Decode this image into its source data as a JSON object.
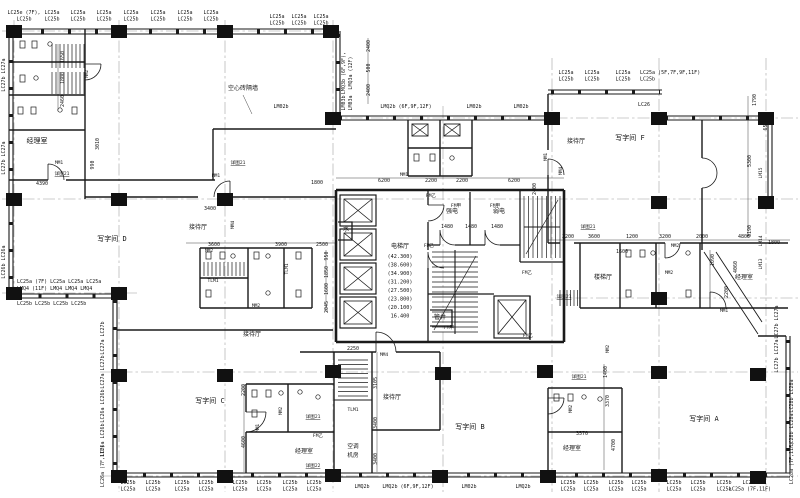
{
  "drawing": {
    "type": "architectural floor plan (office tower typical floor)",
    "ink": "#1a1a1a",
    "axis_color": "#9a9a9a"
  },
  "window_tags": [
    {
      "t": "LC25e (7F),",
      "t2": "LC25b",
      "x": 24,
      "y": 14
    },
    {
      "t": "LC25a",
      "t2": "LC25b",
      "x": 52,
      "y": 14
    },
    {
      "t": "LC25a",
      "t2": "LC25b",
      "x": 78,
      "y": 14
    },
    {
      "t": "LC25a",
      "t2": "LC25b",
      "x": 104,
      "y": 14
    },
    {
      "t": "LC25a",
      "t2": "LC25b",
      "x": 131,
      "y": 14
    },
    {
      "t": "LC25a",
      "t2": "LC25b",
      "x": 158,
      "y": 14
    },
    {
      "t": "LC25a",
      "t2": "LC25b",
      "x": 185,
      "y": 14
    },
    {
      "t": "LC25a",
      "t2": "LC25b",
      "x": 211,
      "y": 14
    },
    {
      "t": "LC25a",
      "t2": "LC25b",
      "x": 277,
      "y": 18
    },
    {
      "t": "LC25a",
      "t2": "LC25b",
      "x": 299,
      "y": 18
    },
    {
      "t": "LC25a",
      "t2": "LC25b",
      "x": 321,
      "y": 18
    },
    {
      "t": "LC25a",
      "t2": "LC25b",
      "x": 566,
      "y": 74
    },
    {
      "t": "LC25a",
      "t2": "LC25b",
      "x": 592,
      "y": 74
    },
    {
      "t": "LC25a",
      "t2": "LC25b",
      "x": 623,
      "y": 74
    },
    {
      "t": "LC25a (5F,7F,9F,11F)",
      "t2": "LC25b",
      "x": 640,
      "y": 74,
      "a": "start"
    },
    {
      "t": "LC26",
      "x": 644,
      "y": 106
    },
    {
      "t": "LMQ3b (6F,9F),",
      "x": 345,
      "y": 73,
      "r": -90
    },
    {
      "t": "LMQ3a (12F)",
      "x": 352,
      "y": 73,
      "r": -90
    },
    {
      "t": "LM03b",
      "x": 345,
      "y": 103,
      "r": -90
    },
    {
      "t": "LM03a",
      "x": 352,
      "y": 103,
      "r": -90
    },
    {
      "t": "LM02b",
      "x": 281,
      "y": 108
    },
    {
      "t": "LMQ2b (6F,9F,12F)",
      "x": 406,
      "y": 108
    },
    {
      "t": "LM02b",
      "x": 474,
      "y": 108
    },
    {
      "t": "LM02b",
      "x": 521,
      "y": 108
    },
    {
      "t": "LC27b LC27a",
      "x": 5,
      "y": 75,
      "r": -90
    },
    {
      "t": "LC27b LC27a",
      "x": 5,
      "y": 158,
      "r": -90
    },
    {
      "t": "LC26b LC26a",
      "x": 5,
      "y": 262,
      "r": -90
    },
    {
      "t": "LC25a (7F)   LC25a    LC25a    LC25a",
      "x": 17,
      "y": 283,
      "a": "start"
    },
    {
      "t": "LMQ4 (11F)  LMQ4    LMQ4    LMQ4",
      "x": 17,
      "y": 290,
      "a": "start"
    },
    {
      "t": "LC25b       LC25b     LC25b     LC25b",
      "x": 17,
      "y": 305,
      "a": "start"
    },
    {
      "t": "LC27a LC27b",
      "x": 104,
      "y": 338,
      "r": -90
    },
    {
      "t": "LC27a LC27b",
      "x": 104,
      "y": 372,
      "r": -90
    },
    {
      "t": "LC26a LC26b",
      "x": 104,
      "y": 406,
      "r": -90
    },
    {
      "t": "LC26a LC26b",
      "x": 104,
      "y": 440,
      "r": -90
    },
    {
      "t": "LC26a (7F,11F)",
      "x": 104,
      "y": 466,
      "r": -90
    },
    {
      "t": "LC27b LC27a",
      "x": 778,
      "y": 322,
      "r": -90
    },
    {
      "t": "LC27b LC27a",
      "x": 778,
      "y": 356,
      "r": -90
    },
    {
      "t": "LC28b LC28a",
      "x": 793,
      "y": 396,
      "r": -90
    },
    {
      "t": "LC28b LC28a",
      "x": 793,
      "y": 430,
      "r": -90
    },
    {
      "t": "LC28a (7F,11F)",
      "x": 793,
      "y": 463,
      "r": -90
    },
    {
      "t": "LC25b",
      "t2": "LC25a",
      "x": 128,
      "y": 484
    },
    {
      "t": "LC25b",
      "t2": "LC25a",
      "x": 153,
      "y": 484
    },
    {
      "t": "LC25b",
      "t2": "LC25a",
      "x": 182,
      "y": 484
    },
    {
      "t": "LC25b",
      "t2": "LC25a",
      "x": 206,
      "y": 484
    },
    {
      "t": "LC25b",
      "t2": "LC25a",
      "x": 240,
      "y": 484
    },
    {
      "t": "LC25b",
      "t2": "LC25a",
      "x": 264,
      "y": 484
    },
    {
      "t": "LC25b",
      "t2": "LC25a",
      "x": 290,
      "y": 484
    },
    {
      "t": "LC25b",
      "t2": "LC25a",
      "x": 314,
      "y": 484
    },
    {
      "t": "LMQ2b",
      "x": 362,
      "y": 488
    },
    {
      "t": "LMQ2b (6F,9F,12F)",
      "x": 408,
      "y": 488
    },
    {
      "t": "LM02b",
      "x": 469,
      "y": 488
    },
    {
      "t": "LMQ2b",
      "x": 523,
      "y": 488
    },
    {
      "t": "LC25b",
      "t2": "LC25a",
      "x": 568,
      "y": 484
    },
    {
      "t": "LC25b",
      "t2": "LC25a",
      "x": 591,
      "y": 484
    },
    {
      "t": "LC25b",
      "t2": "LC25a",
      "x": 616,
      "y": 484
    },
    {
      "t": "LC25b",
      "t2": "LC25a",
      "x": 639,
      "y": 484
    },
    {
      "t": "LC25b",
      "t2": "LC25a",
      "x": 674,
      "y": 484
    },
    {
      "t": "LC25b",
      "t2": "LC25a",
      "x": 698,
      "y": 484
    },
    {
      "t": "LC25b",
      "t2": "LC25a",
      "x": 724,
      "y": 484
    },
    {
      "t": "LC25b",
      "t2": "LC25a (7F,11F)",
      "x": 750,
      "y": 484
    }
  ],
  "rooms": [
    {
      "t": "经理室",
      "x": 37,
      "y": 143
    },
    {
      "t": "写字间 D",
      "x": 112,
      "y": 241
    },
    {
      "t": "接待厅",
      "x": 198,
      "y": 229,
      "s": 6
    },
    {
      "t": "接待厅",
      "x": 252,
      "y": 336,
      "s": 6
    },
    {
      "t": "写字间 C",
      "x": 210,
      "y": 403
    },
    {
      "t": "经理室",
      "x": 304,
      "y": 453,
      "s": 6
    },
    {
      "t": "空调",
      "x": 353,
      "y": 448,
      "s": 5.6
    },
    {
      "t": "机房",
      "x": 353,
      "y": 457,
      "s": 5.6
    },
    {
      "t": "接待厅",
      "x": 392,
      "y": 399,
      "s": 6
    },
    {
      "t": "写字间 B",
      "x": 470,
      "y": 429
    },
    {
      "t": "经理室",
      "x": 572,
      "y": 450,
      "s": 6
    },
    {
      "t": "写字间 A",
      "x": 704,
      "y": 421
    },
    {
      "t": "写字间 F",
      "x": 630,
      "y": 140
    },
    {
      "t": "接待厅",
      "x": 576,
      "y": 143,
      "s": 6
    },
    {
      "t": "楼梯厅",
      "x": 603,
      "y": 279,
      "s": 6
    },
    {
      "t": "经理室",
      "x": 744,
      "y": 279,
      "s": 6
    },
    {
      "t": "电梯厅",
      "x": 400,
      "y": 248,
      "s": 6
    },
    {
      "t": "强电",
      "x": 452,
      "y": 213,
      "s": 6
    },
    {
      "t": "弱电",
      "x": 499,
      "y": 213,
      "s": 6
    },
    {
      "t": "管井",
      "x": 440,
      "y": 319,
      "s": 6
    },
    {
      "t": "水",
      "x": 346,
      "y": 231,
      "s": 6
    },
    {
      "t": "空心砖隔墙",
      "x": 243,
      "y": 90,
      "s": 6
    }
  ],
  "levels": [
    {
      "t": "(42.300)",
      "x": 400,
      "y": 258
    },
    {
      "t": "(38.600)",
      "x": 400,
      "y": 266.5
    },
    {
      "t": "(34.900)",
      "x": 400,
      "y": 275
    },
    {
      "t": "(31.200)",
      "x": 400,
      "y": 283.5
    },
    {
      "t": "(27.500)",
      "x": 400,
      "y": 292
    },
    {
      "t": "(23.800)",
      "x": 400,
      "y": 300.5
    },
    {
      "t": "(20.100)",
      "x": 400,
      "y": 309
    },
    {
      "t": "16.400",
      "x": 400,
      "y": 317.5
    }
  ],
  "doors": [
    {
      "t": "MM1",
      "x": 59,
      "y": 164
    },
    {
      "t": "MM1",
      "x": 216,
      "y": 177
    },
    {
      "t": "MM1",
      "x": 404,
      "y": 176
    },
    {
      "t": "MM1",
      "x": 259,
      "y": 428,
      "r": -90
    },
    {
      "t": "MM1",
      "x": 724,
      "y": 312
    },
    {
      "t": "MM1",
      "x": 547,
      "y": 157,
      "r": -90
    },
    {
      "t": "MM2",
      "x": 88,
      "y": 74,
      "r": -90
    },
    {
      "t": "MM2",
      "x": 209,
      "y": 252
    },
    {
      "t": "MM2",
      "x": 256,
      "y": 307
    },
    {
      "t": "MM2",
      "x": 282,
      "y": 411,
      "r": -90
    },
    {
      "t": "MM2",
      "x": 675,
      "y": 247
    },
    {
      "t": "MM2",
      "x": 669,
      "y": 274
    },
    {
      "t": "MM2",
      "x": 609,
      "y": 349,
      "r": -90
    },
    {
      "t": "MM2",
      "x": 572,
      "y": 409,
      "r": -90
    },
    {
      "t": "MM4",
      "x": 234,
      "y": 225,
      "r": -90
    },
    {
      "t": "MM4",
      "x": 384,
      "y": 356
    },
    {
      "t": "MM4",
      "x": 562,
      "y": 171,
      "r": -90
    },
    {
      "t": "FM甲",
      "x": 456,
      "y": 207
    },
    {
      "t": "FM甲",
      "x": 495,
      "y": 207
    },
    {
      "t": "FM甲",
      "x": 449,
      "y": 329
    },
    {
      "t": "FM乙",
      "x": 431,
      "y": 197
    },
    {
      "t": "FM乙",
      "x": 429,
      "y": 247
    },
    {
      "t": "FM乙",
      "x": 527,
      "y": 274
    },
    {
      "t": "FM乙",
      "x": 528,
      "y": 337
    },
    {
      "t": "FM乙",
      "x": 318,
      "y": 437
    },
    {
      "t": "TLM1",
      "x": 213,
      "y": 282
    },
    {
      "t": "TLM1",
      "x": 288,
      "y": 269,
      "r": -90
    },
    {
      "t": "TLM1",
      "x": 353,
      "y": 411
    },
    {
      "t": "LM15",
      "x": 762,
      "y": 173,
      "r": -90
    },
    {
      "t": "LM14",
      "x": 762,
      "y": 241,
      "r": -90
    },
    {
      "t": "LM13",
      "x": 762,
      "y": 264,
      "r": -90
    }
  ],
  "notes": [
    {
      "t": "详图21",
      "x": 62,
      "y": 175
    },
    {
      "t": "详图21",
      "x": 238,
      "y": 164
    },
    {
      "t": "详图21",
      "x": 313,
      "y": 418
    },
    {
      "t": "详图21",
      "x": 588,
      "y": 228
    },
    {
      "t": "详图21",
      "x": 564,
      "y": 298
    },
    {
      "t": "详图22",
      "x": 313,
      "y": 467
    },
    {
      "t": "详图21",
      "x": 579,
      "y": 378
    }
  ],
  "dims": [
    {
      "t": "1650",
      "x": 64,
      "y": 57,
      "r": -90
    },
    {
      "t": "1800",
      "x": 64,
      "y": 78,
      "r": -90
    },
    {
      "t": "2460",
      "x": 64,
      "y": 101,
      "r": -90
    },
    {
      "t": "3010",
      "x": 99,
      "y": 144,
      "r": -90
    },
    {
      "t": "990",
      "x": 94,
      "y": 165,
      "r": -90
    },
    {
      "t": "4390",
      "x": 42,
      "y": 185
    },
    {
      "t": "3400",
      "x": 210,
      "y": 210
    },
    {
      "t": "1800",
      "x": 317,
      "y": 184
    },
    {
      "t": "2400",
      "x": 370,
      "y": 46,
      "r": -90
    },
    {
      "t": "500",
      "x": 370,
      "y": 68,
      "r": -90
    },
    {
      "t": "2400",
      "x": 370,
      "y": 90,
      "r": -90
    },
    {
      "t": "6200",
      "x": 384,
      "y": 182
    },
    {
      "t": "2200",
      "x": 431,
      "y": 182
    },
    {
      "t": "2200",
      "x": 462,
      "y": 182
    },
    {
      "t": "6200",
      "x": 514,
      "y": 182
    },
    {
      "t": "2400",
      "x": 536,
      "y": 189,
      "r": -90
    },
    {
      "t": "1480",
      "x": 447,
      "y": 228
    },
    {
      "t": "1480",
      "x": 471,
      "y": 228
    },
    {
      "t": "1480",
      "x": 497,
      "y": 228
    },
    {
      "t": "3600",
      "x": 214,
      "y": 246
    },
    {
      "t": "3900",
      "x": 281,
      "y": 246
    },
    {
      "t": "2500",
      "x": 322,
      "y": 246
    },
    {
      "t": "950",
      "x": 328,
      "y": 256,
      "r": -90
    },
    {
      "t": "1850",
      "x": 328,
      "y": 272,
      "r": -90
    },
    {
      "t": "1600",
      "x": 328,
      "y": 289,
      "r": -90
    },
    {
      "t": "2045",
      "x": 328,
      "y": 307,
      "r": -90
    },
    {
      "t": "2250",
      "x": 353,
      "y": 350
    },
    {
      "t": "3105",
      "x": 377,
      "y": 383,
      "r": -90
    },
    {
      "t": "3400",
      "x": 377,
      "y": 423,
      "r": -90
    },
    {
      "t": "3400",
      "x": 377,
      "y": 459,
      "r": -90
    },
    {
      "t": "2200",
      "x": 245,
      "y": 390,
      "r": -90
    },
    {
      "t": "4600",
      "x": 245,
      "y": 442,
      "r": -90
    },
    {
      "t": "1790",
      "x": 756,
      "y": 100,
      "r": -90
    },
    {
      "t": "650",
      "x": 767,
      "y": 126,
      "r": -90
    },
    {
      "t": "5300",
      "x": 751,
      "y": 161,
      "r": -90
    },
    {
      "t": "3190",
      "x": 751,
      "y": 231,
      "r": -90
    },
    {
      "t": "2200",
      "x": 568,
      "y": 238
    },
    {
      "t": "3600",
      "x": 594,
      "y": 238
    },
    {
      "t": "1200",
      "x": 632,
      "y": 238
    },
    {
      "t": "3200",
      "x": 665,
      "y": 238
    },
    {
      "t": "2000",
      "x": 702,
      "y": 238
    },
    {
      "t": "4800",
      "x": 744,
      "y": 238
    },
    {
      "t": "1800",
      "x": 774,
      "y": 244
    },
    {
      "t": "1090",
      "x": 714,
      "y": 260,
      "r": -90
    },
    {
      "t": "4060",
      "x": 737,
      "y": 267,
      "r": -90
    },
    {
      "t": "2200",
      "x": 728,
      "y": 292,
      "r": -90
    },
    {
      "t": "1600",
      "x": 622,
      "y": 253
    },
    {
      "t": "3570",
      "x": 582,
      "y": 435
    },
    {
      "t": "3370",
      "x": 609,
      "y": 401,
      "r": -90
    },
    {
      "t": "4700",
      "x": 615,
      "y": 445,
      "r": -90
    },
    {
      "t": "1400",
      "x": 607,
      "y": 372,
      "r": -90
    }
  ]
}
